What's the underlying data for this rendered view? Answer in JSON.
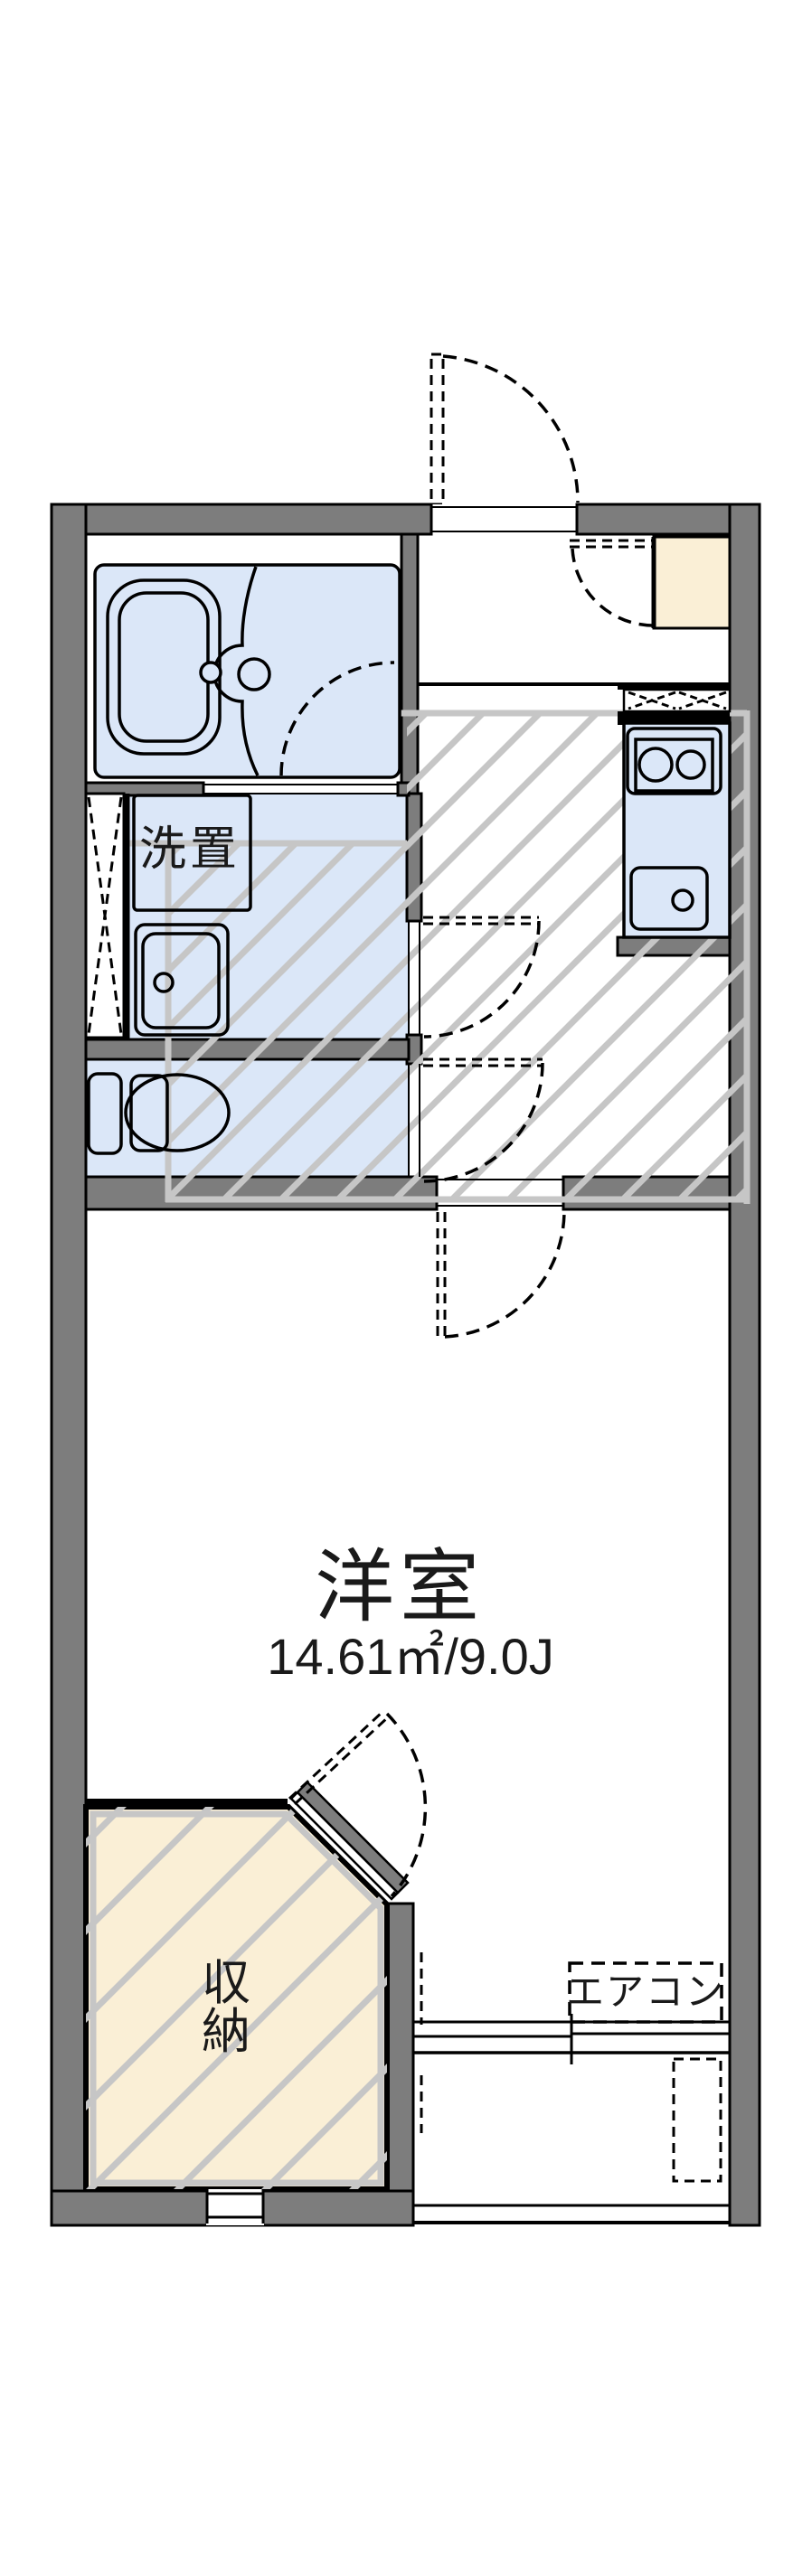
{
  "title": "apartment-floorplan",
  "colors": {
    "wall": "#7d7d7d",
    "water": "#dbe7f8",
    "cream": "#faefd6",
    "hatch": "#c6c6c6",
    "line": "#000000"
  },
  "rooms": {
    "western_room": {
      "label": "洋室",
      "size_label": "14.61㎡/9.0J"
    },
    "laundry": {
      "label": "洗置"
    },
    "closet": {
      "label_line1": "収",
      "label_line2": "納"
    },
    "aircon": {
      "label": "エアコン"
    }
  }
}
